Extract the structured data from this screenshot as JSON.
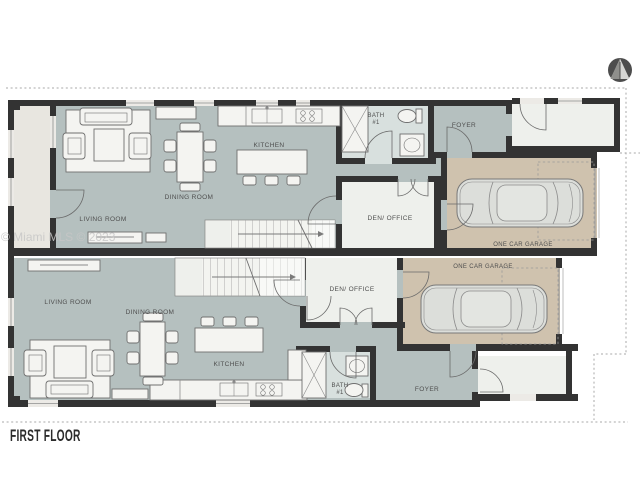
{
  "page": {
    "floor_label": "FIRST FLOOR",
    "watermark": "© Miami MLS © 2023",
    "compass_icon": "north-arrow"
  },
  "colors": {
    "wall": "#333333",
    "floor": "#b5c0bf",
    "garage": "#cfc2ae",
    "room_light": "#eef0ec",
    "bath_floor": "#d8e0de",
    "porch": "#e8e6e0",
    "furniture": "#f4f4f1",
    "outline": "#6f6f6f",
    "dashline": "#a9a9a9",
    "label": "#4f4f4f",
    "watermark": "#c7c7c7",
    "title": "#2b2b2b"
  },
  "units": {
    "upper": {
      "living_room": "LIVING ROOM",
      "dining_room": "DINING ROOM",
      "kitchen": "KITCHEN",
      "den_office": "DEN/ OFFICE",
      "foyer": "FOYER",
      "bath_line1": "BATH",
      "bath_line2": "#1",
      "garage": "ONE CAR GARAGE"
    },
    "lower": {
      "living_room": "LIVING ROOM",
      "dining_room": "DINING ROOM",
      "kitchen": "KITCHEN",
      "den_office": "DEN/ OFFICE",
      "foyer": "FOYER",
      "bath_line1": "BATH",
      "bath_line2": "#1",
      "garage": "ONE CAR GARAGE"
    }
  }
}
